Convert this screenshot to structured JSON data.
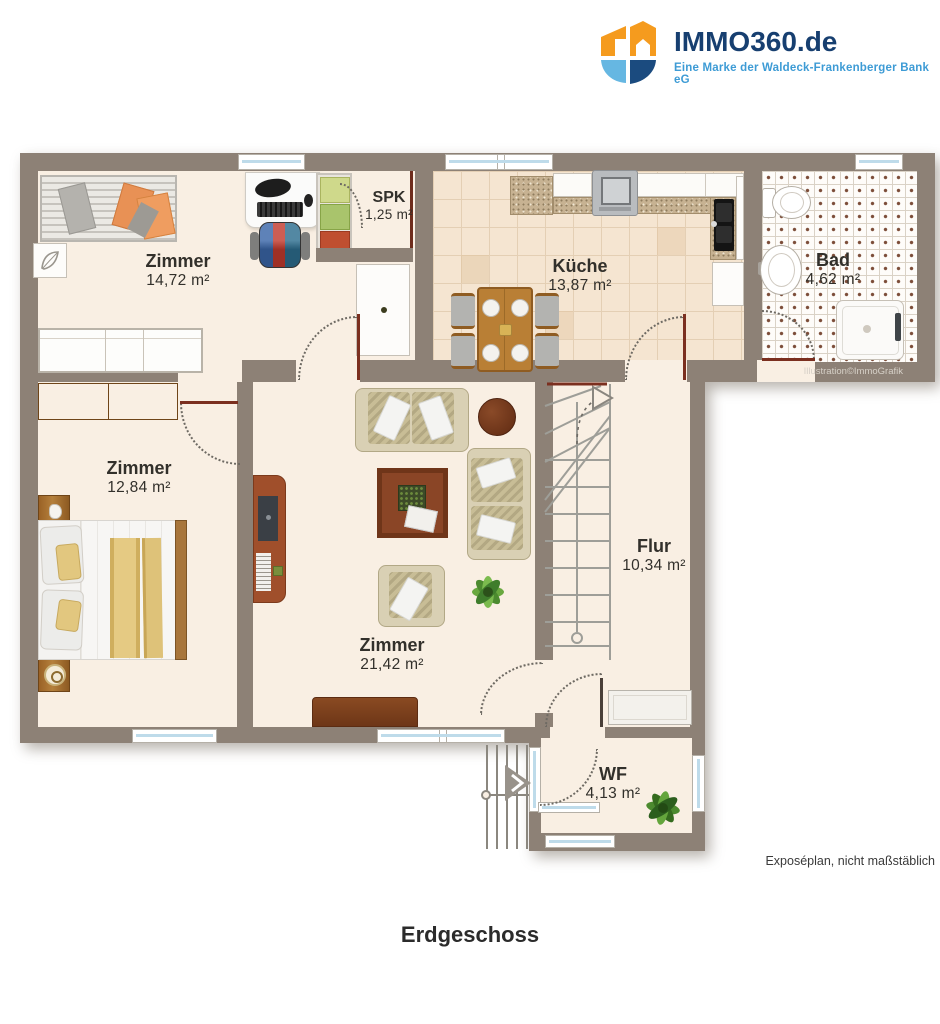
{
  "logo": {
    "brand": "IMMO360.de",
    "tagline": "Eine Marke der Waldeck-Frankenberger Bank eG",
    "colors": {
      "orange": "#F59B1E",
      "light_blue": "#66B7E2",
      "navy": "#1B4B7F",
      "brand_text": "#173F70",
      "tagline_text": "#3D9BD5"
    }
  },
  "plan": {
    "colors": {
      "wall": "#8d8176",
      "floor": "#f9efe3",
      "kitchen_tile": "#f5e5d1",
      "bath_tile": "#fefcf9",
      "door_leaf": "#7b2f1f",
      "window_glass": "#bedbea"
    },
    "rooms": {
      "zimmer_top": {
        "name": "Zimmer",
        "area": "14,72 m²"
      },
      "spk": {
        "name": "SPK",
        "area": "1,25 m²"
      },
      "kueche": {
        "name": "Küche",
        "area": "13,87 m²"
      },
      "bad": {
        "name": "Bad",
        "area": "4,62 m²"
      },
      "zimmer_bed": {
        "name": "Zimmer",
        "area": "12,84 m²"
      },
      "zimmer_living": {
        "name": "Zimmer",
        "area": "21,42 m²"
      },
      "flur": {
        "name": "Flur",
        "area": "10,34 m²"
      },
      "wf": {
        "name": "WF",
        "area": "4,13 m²"
      }
    },
    "credit": "Illustration©ImmoGrafik"
  },
  "footer": {
    "scale_note": "Exposéplan, nicht maßstäblich",
    "floor_title": "Erdgeschoss"
  }
}
